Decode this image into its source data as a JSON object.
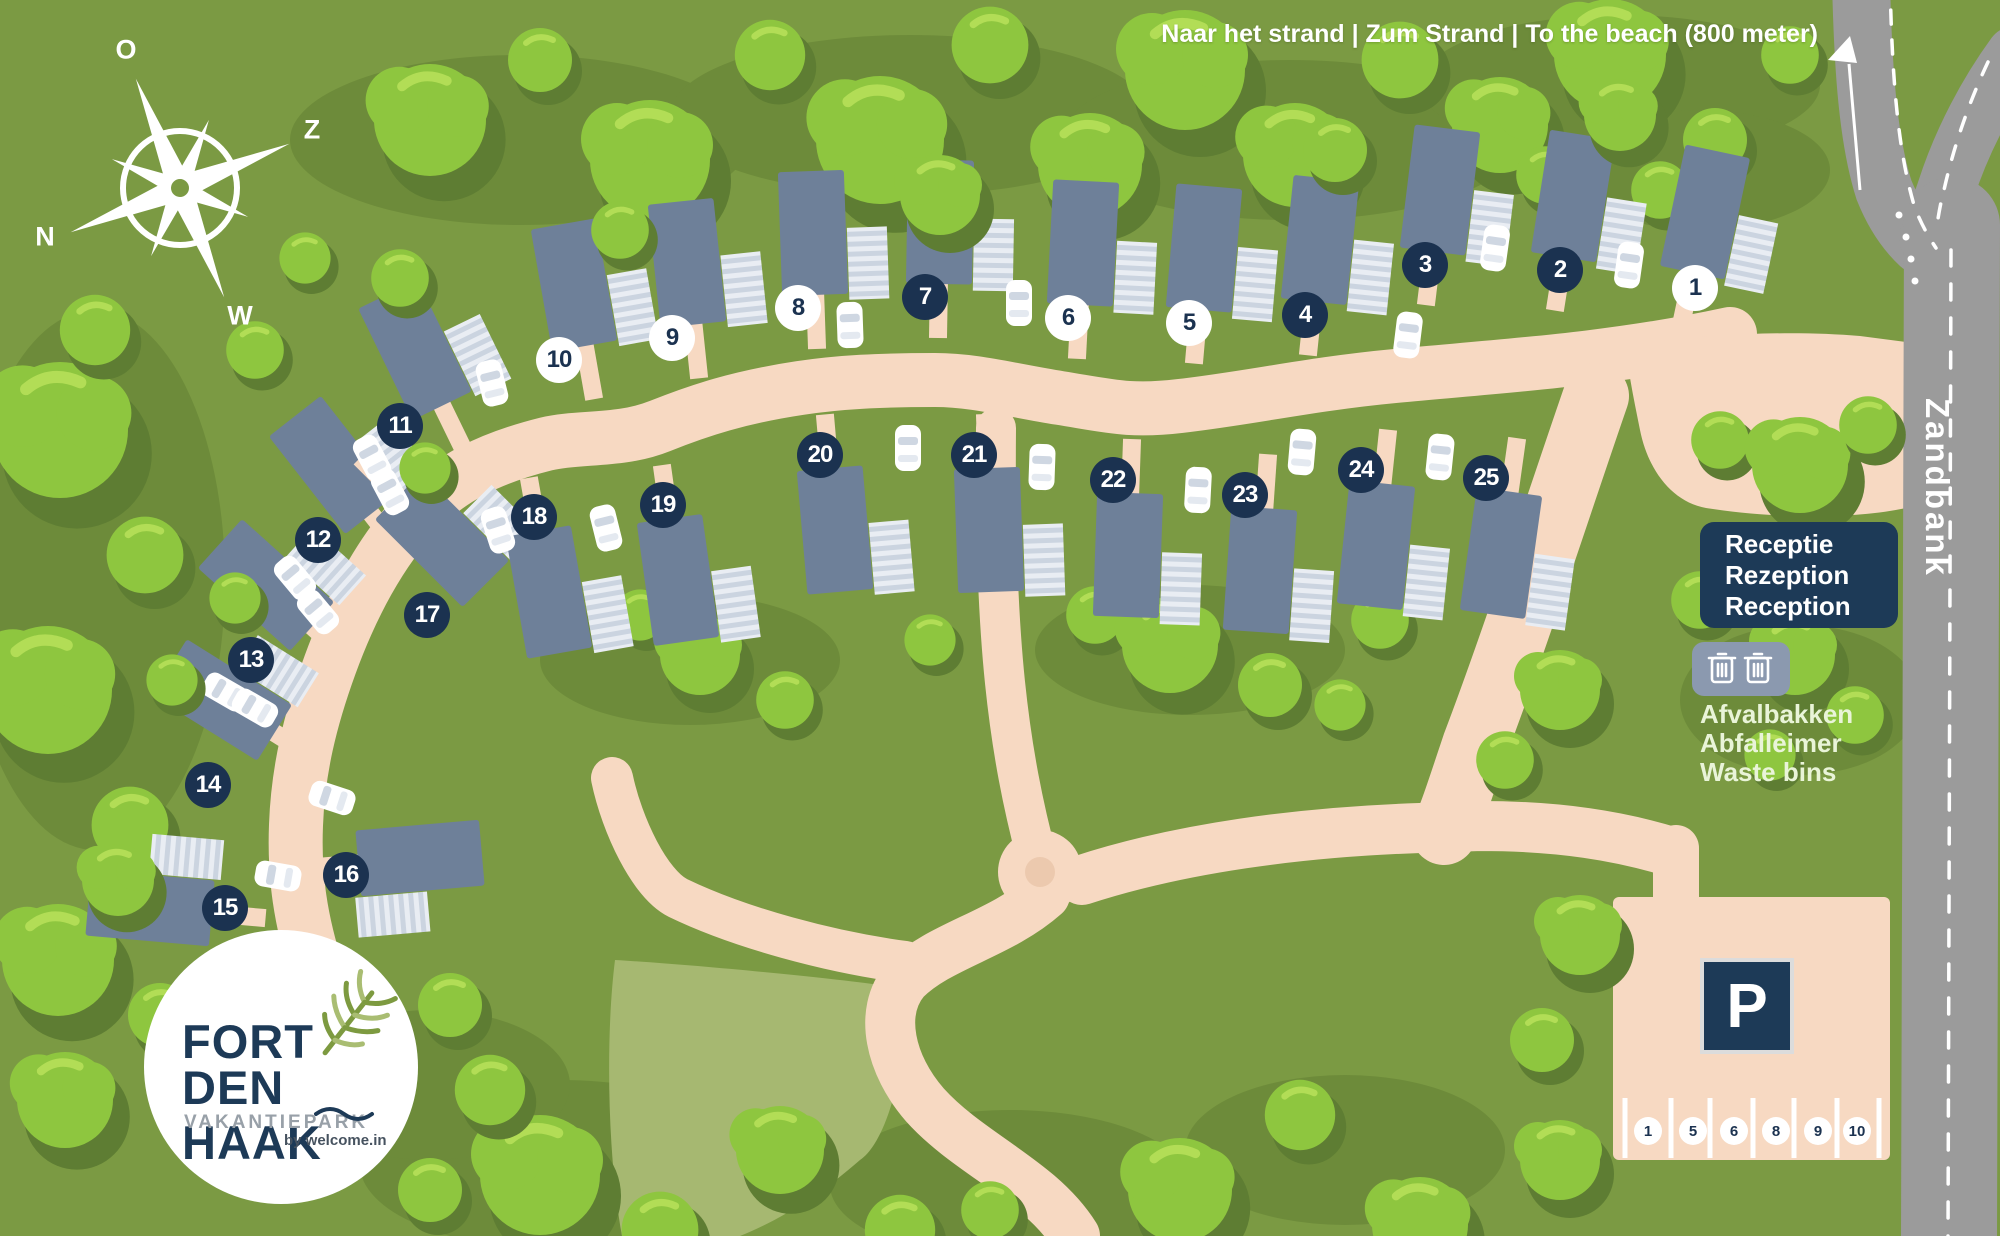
{
  "beach_sign": "Naar het strand | Zum Strand | To the beach (800 meter)",
  "road_label": "Zandbank",
  "compass": {
    "o": "O",
    "z": "Z",
    "n": "N",
    "w": "W"
  },
  "reception": [
    "Receptie",
    "Rezeption",
    "Reception"
  ],
  "waste": [
    "Afvalbakken",
    "Abfalleimer",
    "Waste bins"
  ],
  "parking": {
    "letter": "P",
    "spots": [
      "1",
      "5",
      "6",
      "8",
      "9",
      "10"
    ]
  },
  "logo": {
    "line1": "FORT",
    "line2": "DEN HAAK",
    "line3": "VAKANTIEPARK",
    "byline": "by welcome.in"
  },
  "houses": [
    {
      "label": "1",
      "variant": "light"
    },
    {
      "label": "2",
      "variant": "dark"
    },
    {
      "label": "3",
      "variant": "dark"
    },
    {
      "label": "4",
      "variant": "dark"
    },
    {
      "label": "5",
      "variant": "light"
    },
    {
      "label": "6",
      "variant": "light"
    },
    {
      "label": "7",
      "variant": "dark"
    },
    {
      "label": "8",
      "variant": "light"
    },
    {
      "label": "9",
      "variant": "light"
    },
    {
      "label": "10",
      "variant": "light"
    },
    {
      "label": "11",
      "variant": "dark"
    },
    {
      "label": "12",
      "variant": "dark"
    },
    {
      "label": "13",
      "variant": "dark"
    },
    {
      "label": "14",
      "variant": "dark"
    },
    {
      "label": "15",
      "variant": "dark"
    },
    {
      "label": "16",
      "variant": "dark"
    },
    {
      "label": "17",
      "variant": "dark"
    },
    {
      "label": "18",
      "variant": "dark"
    },
    {
      "label": "19",
      "variant": "dark"
    },
    {
      "label": "20",
      "variant": "dark"
    },
    {
      "label": "21",
      "variant": "dark"
    },
    {
      "label": "22",
      "variant": "dark"
    },
    {
      "label": "23",
      "variant": "dark"
    },
    {
      "label": "24",
      "variant": "dark"
    },
    {
      "label": "25",
      "variant": "dark"
    }
  ],
  "colors": {
    "background": "#7b9a43",
    "tree": "#8ec63f",
    "tree_shadow": "#5e7d33",
    "house": "#6e8099",
    "path": "#f7d9c2",
    "asphalt": "#9b9b9b",
    "navy": "#1b3250",
    "sign_navy": "#1d3a57",
    "bins_box": "#8b99af",
    "field_patch": "#a6b871",
    "deck": "#cbd4e0"
  }
}
